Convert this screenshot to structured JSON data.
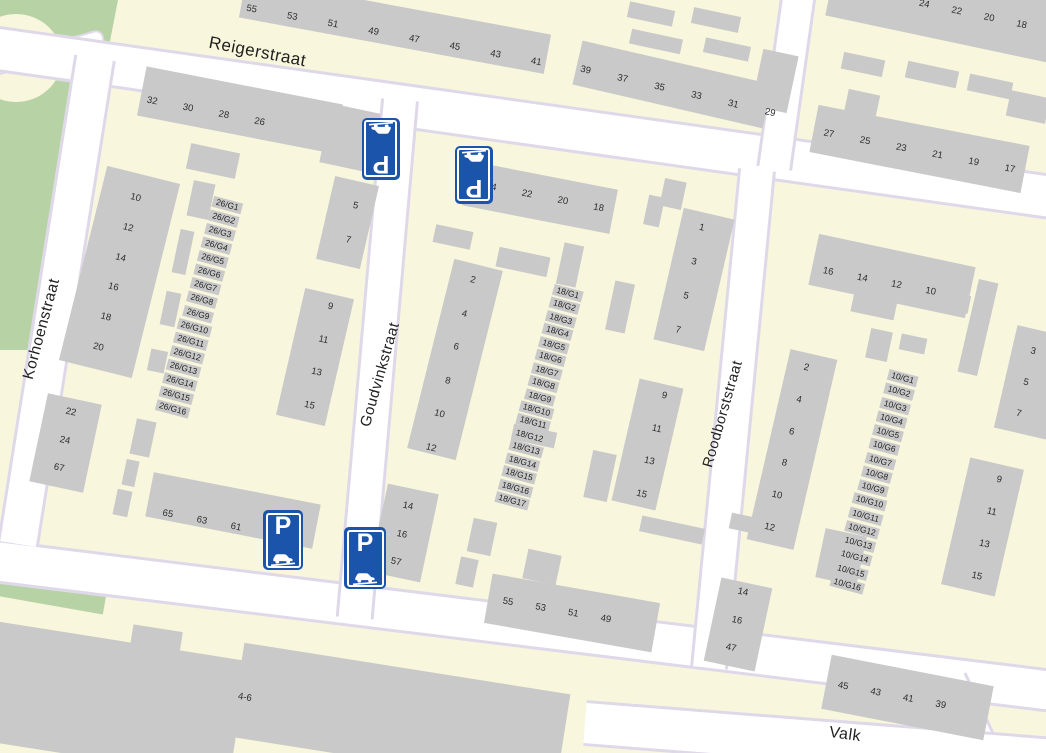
{
  "streets": {
    "reigerstraat": "Reigerstraat",
    "korhoenstraat": "Korhoenstraat",
    "goudvinkstraat": "Goudvinkstraat",
    "roodborststraat": "Roodborststraat",
    "valkstraat_partial": "Valk"
  },
  "parking": {
    "p": "P"
  },
  "house_numbers": {
    "top_strip_a": [
      "55",
      "53",
      "51",
      "49",
      "47",
      "45",
      "43",
      "41"
    ],
    "top_strip_b": [
      "39",
      "37",
      "35",
      "33",
      "31",
      "29"
    ],
    "top_right_strip": [
      "24",
      "22",
      "20",
      "18"
    ],
    "strip_27_17": [
      "27",
      "25",
      "23",
      "21",
      "19",
      "17"
    ],
    "strip_32_26": [
      "32",
      "30",
      "28",
      "26"
    ],
    "left_slab": [
      "10",
      "12",
      "14",
      "16",
      "18",
      "20"
    ],
    "left_low": [
      "22",
      "24",
      "67"
    ],
    "left_5_7": [
      "5",
      "7"
    ],
    "left_9_15": [
      "9",
      "11",
      "13",
      "15"
    ],
    "left_65_61": [
      "65",
      "63",
      "61"
    ],
    "mid_top": [
      "24",
      "22",
      "20",
      "18"
    ],
    "mid_left_slab": [
      "2",
      "4",
      "6",
      "8",
      "10",
      "12"
    ],
    "mid_right_slab": [
      "1",
      "3",
      "5",
      "7"
    ],
    "mid_9_15": [
      "9",
      "11",
      "13",
      "15"
    ],
    "mid_low": [
      "14",
      "16",
      "57"
    ],
    "mid_bottom_strip": [
      "55",
      "53",
      "51",
      "49"
    ],
    "right_top_strip": [
      "16",
      "14",
      "12",
      "10"
    ],
    "right_left_slab": [
      "2",
      "4",
      "6",
      "8",
      "10",
      "12"
    ],
    "right_edge_slab": [
      "3",
      "5",
      "7"
    ],
    "right_9_15": [
      "9",
      "11",
      "13",
      "15"
    ],
    "right_low": [
      "14",
      "16",
      "47"
    ],
    "right_bottom_strip": [
      "45",
      "43",
      "41",
      "39"
    ]
  },
  "garage_numbers": {
    "block_26": [
      "26/G1",
      "26/G2",
      "26/G3",
      "26/G4",
      "26/G5",
      "26/G6",
      "26/G7",
      "26/G8",
      "26/G9",
      "26/G10",
      "26/G11",
      "26/G12",
      "26/G13",
      "26/G14",
      "26/G15",
      "26/G16"
    ],
    "block_18": [
      "18/G1",
      "18/G2",
      "18/G3",
      "18/G4",
      "18/G5",
      "18/G6",
      "18/G7",
      "18/G8",
      "18/G9",
      "18/G10",
      "18/G11",
      "18/G12",
      "18/G13",
      "18/G14",
      "18/G15",
      "18/G16",
      "18/G17"
    ],
    "block_10": [
      "10/G1",
      "10/G2",
      "10/G3",
      "10/G4",
      "10/G5",
      "10/G6",
      "10/G7",
      "10/G8",
      "10/G9",
      "10/G10",
      "10/G11",
      "10/G12",
      "10/G13",
      "10/G14",
      "10/G15",
      "10/G16"
    ]
  },
  "building_labels": {
    "bottom_building": "4-6"
  },
  "colors": {
    "block_fill": "#f8f6dc",
    "building_fill": "#c9c9c9",
    "road_fill": "#ffffff",
    "road_casing": "#ded8e8",
    "park_green": "#b7d2a5",
    "sign_blue": "#1b55ab",
    "label_text": "#2e2e2e"
  }
}
